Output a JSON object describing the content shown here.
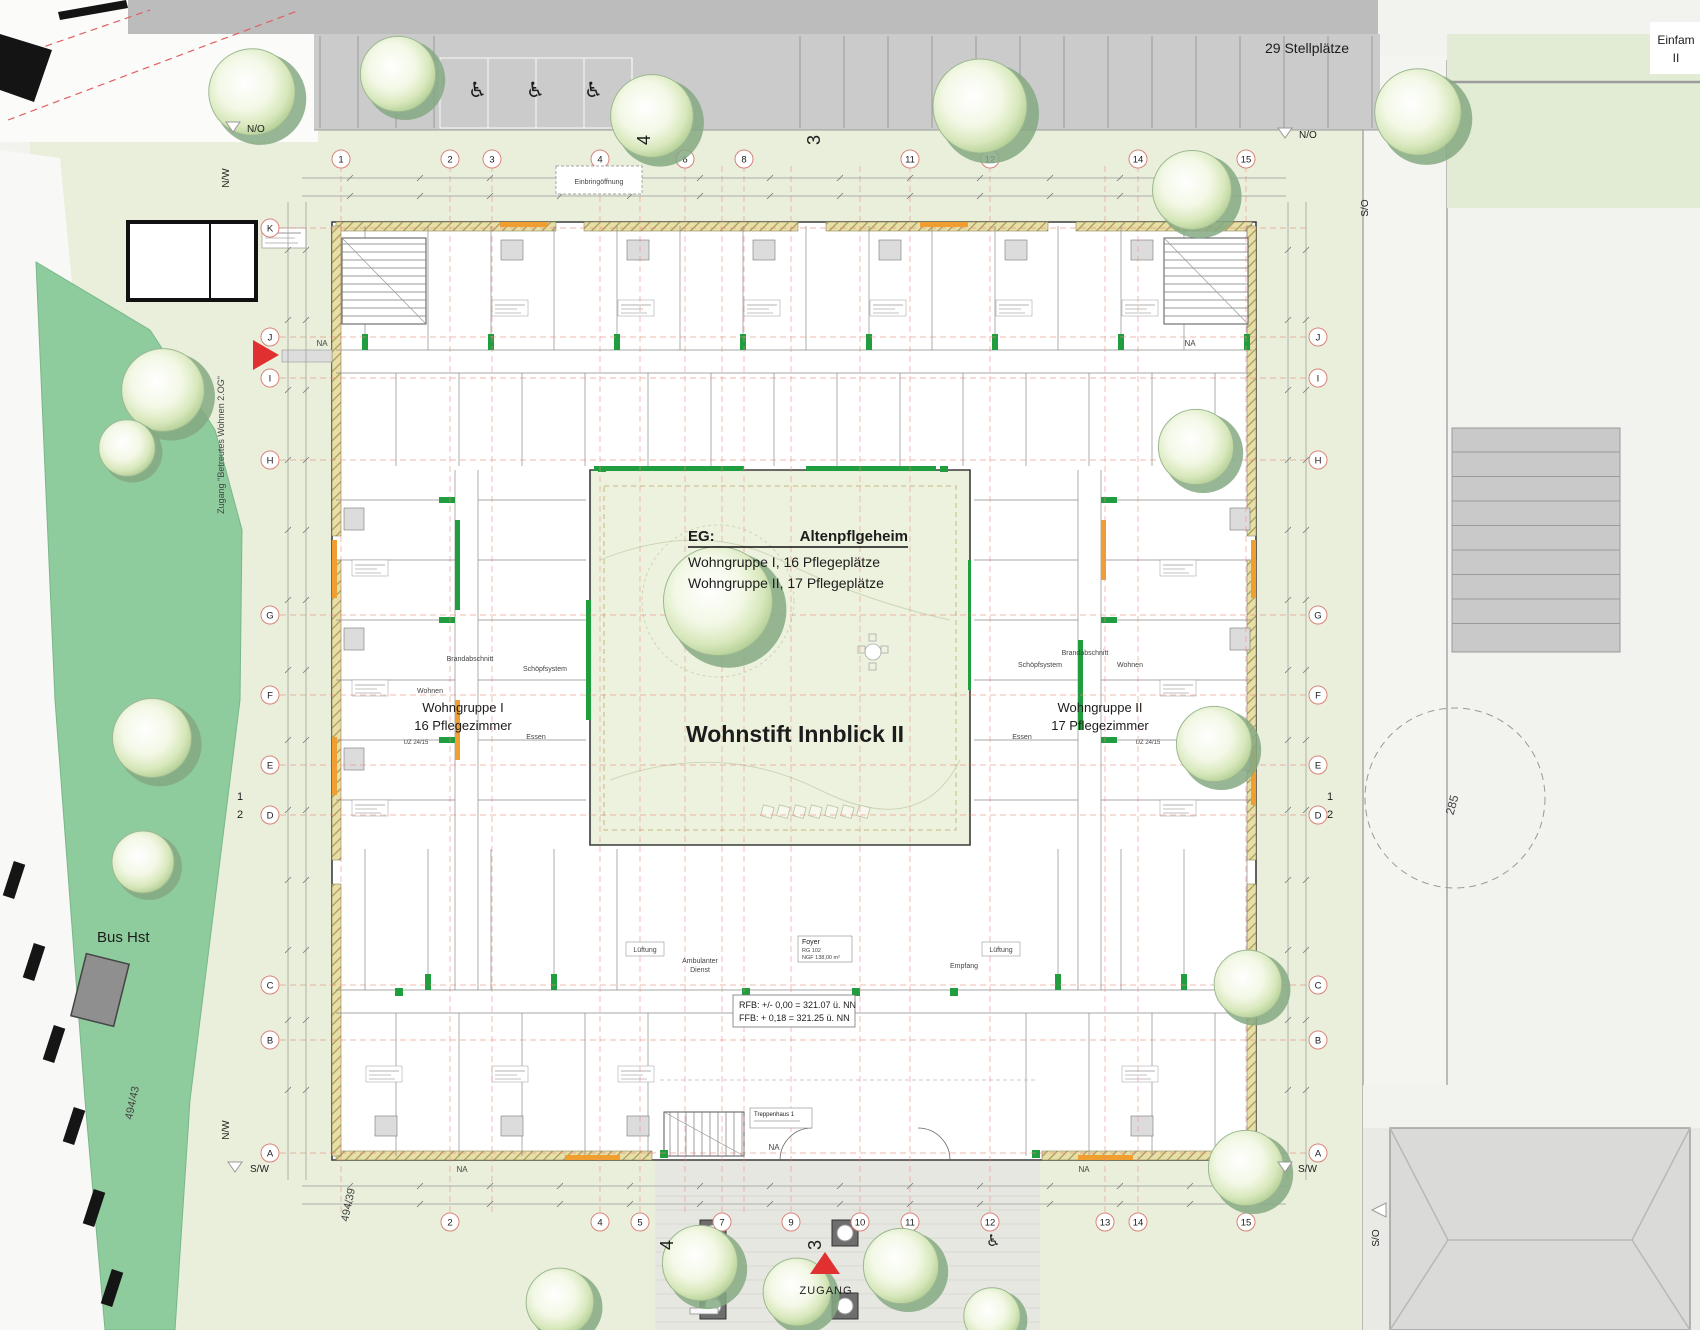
{
  "labels": {
    "stellplaetze": "29 Stellplätze",
    "einfam_line1": "Einfam",
    "einfam_line2": "II",
    "bus": "Bus Hst",
    "parcel_left": "494/43",
    "parcel_bottom": "494/39",
    "parcel_circle": "285",
    "zugang": "ZUGANG",
    "zugang_side": "Zugang \"Betreutes Wohnen 2.OG\"",
    "einbring": "Einbringöffnung"
  },
  "compass": {
    "no": "N/O",
    "nw": "N/W",
    "so": "S/O",
    "sw": "S/W"
  },
  "center": {
    "eg": "EG:",
    "eg_value": "Altenpflgeheim",
    "line1": "Wohngruppe I, 16 Pflegeplätze",
    "line2": "Wohngruppe II, 17 Pflegeplätze",
    "title": "Wohnstift Innblick II"
  },
  "wings": {
    "left1": "Wohngruppe I",
    "left2": "16 Pflegezimmer",
    "right1": "Wohngruppe II",
    "right2": "17 Pflegezimmer"
  },
  "levels": {
    "rfb": "RFB: +/- 0,00 = 321.07 ü. NN",
    "ffb": "FFB:   + 0,18 = 321.25 ü. NN"
  },
  "rooms": {
    "foyer": "Foyer",
    "foyer_rg": "RG 102",
    "foyer_ngf": "NGF 138,00 m²",
    "empfang": "Empfang",
    "amb1": "Ambulanter",
    "amb2": "Dienst",
    "lueftung": "Lüftung",
    "stair": "Treppenhaus 1",
    "na": "NA",
    "brand": "Brandabschnitt",
    "schoepf": "Schöpfsystem",
    "wohnen": "Wohnen",
    "essen": "Essen",
    "uz": "UZ 24/15"
  },
  "grid": {
    "top": [
      "1",
      "2",
      "3",
      "4",
      "6",
      "8",
      "11",
      "12",
      "14",
      "15"
    ],
    "bottom": [
      "2",
      "4",
      "5",
      "7",
      "9",
      "10",
      "11",
      "12",
      "13",
      "14",
      "15"
    ],
    "left": [
      "K",
      "J",
      "I",
      "H",
      "G",
      "F",
      "E",
      "D",
      "C",
      "B",
      "A"
    ],
    "right": [
      "J",
      "I",
      "H",
      "G",
      "F",
      "E",
      "D",
      "C",
      "B",
      "A"
    ],
    "sections": [
      "1",
      "2",
      "3",
      "4"
    ]
  },
  "icons": {
    "wheelchair": "♿"
  },
  "colors": {
    "site_green": "#e9efda",
    "lawn_green": "#8ecb9d",
    "courtyard_green": "#edf2de",
    "parking_gray": "#cbcbcb",
    "road_gray": "#bcbcbc",
    "wall_green": "#1f9d3f",
    "wall_orange": "#ef9e2f",
    "hatch_tan": "#e6dfa8",
    "axis_red": "#e8897e",
    "accent_red": "#e03030"
  }
}
